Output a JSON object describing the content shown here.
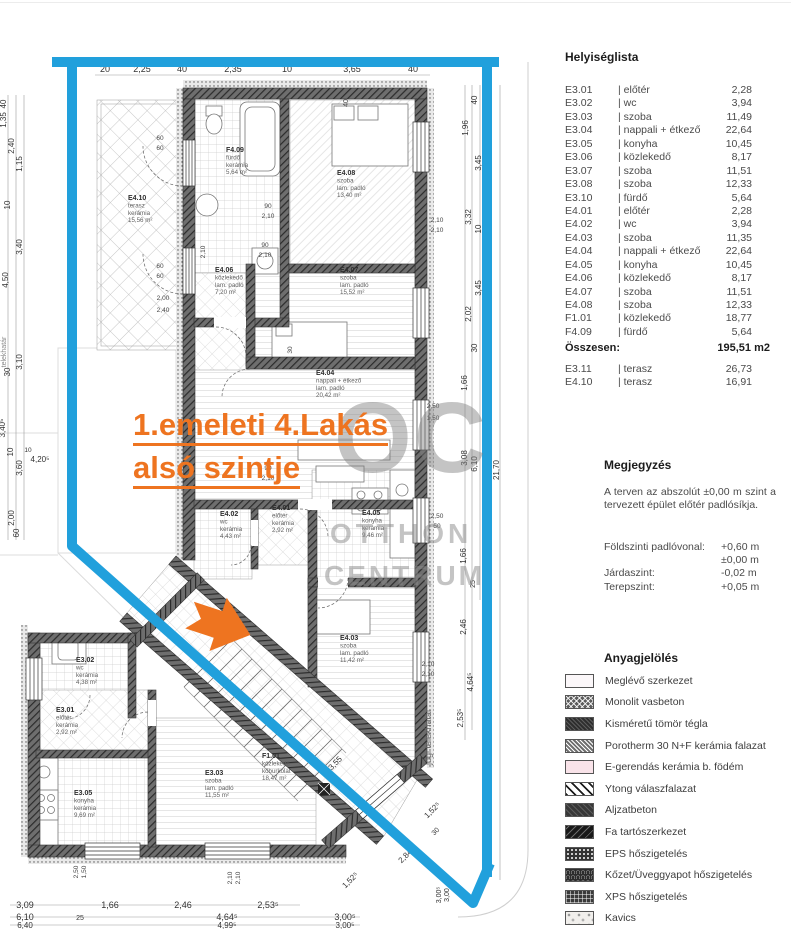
{
  "room_list": {
    "title": "Helyiséglista",
    "rows": [
      {
        "code": "E3.01",
        "name": "| előtér",
        "area": "2,28"
      },
      {
        "code": "E3.02",
        "name": "| wc",
        "area": "3,94"
      },
      {
        "code": "E3.03",
        "name": "| szoba",
        "area": "11,49"
      },
      {
        "code": "E3.04",
        "name": "| nappali + étkező",
        "area": "22,64"
      },
      {
        "code": "E3.05",
        "name": "| konyha",
        "area": "10,45"
      },
      {
        "code": "E3.06",
        "name": "| közlekedő",
        "area": "8,17"
      },
      {
        "code": "E3.07",
        "name": "| szoba",
        "area": "11,51"
      },
      {
        "code": "E3.08",
        "name": "| szoba",
        "area": "12,33"
      },
      {
        "code": "E3.10",
        "name": "| fürdő",
        "area": "5,64"
      },
      {
        "code": "E4.01",
        "name": "| előtér",
        "area": "2,28"
      },
      {
        "code": "E4.02",
        "name": "| wc",
        "area": "3,94"
      },
      {
        "code": "E4.03",
        "name": "| szoba",
        "area": "11,35"
      },
      {
        "code": "E4.04",
        "name": "| nappali + étkező",
        "area": "22,64"
      },
      {
        "code": "E4.05",
        "name": "| konyha",
        "area": "10,45"
      },
      {
        "code": "E4.06",
        "name": "| közlekedő",
        "area": "8,17"
      },
      {
        "code": "E4.07",
        "name": "| szoba",
        "area": "11,51"
      },
      {
        "code": "E4.08",
        "name": "| szoba",
        "area": "12,33"
      },
      {
        "code": "F1.01",
        "name": "| közlekedő",
        "area": "18,77"
      },
      {
        "code": "F4.09",
        "name": "| fürdő",
        "area": "5,64"
      }
    ]
  },
  "total": {
    "label": "Összesen:",
    "value": "195,51 m2"
  },
  "terrace_rows": [
    {
      "code": "E3.11",
      "name": "| terasz",
      "area": "26,73"
    },
    {
      "code": "E4.10",
      "name": "| terasz",
      "area": "16,91"
    }
  ],
  "notes": {
    "title": "Megjegyzés",
    "body": "A terven az abszolút ±0,00 m szint a tervezett épület előtér padlósíkja.",
    "levels": [
      {
        "label": "Földszinti padlóvonal:",
        "value": "+0,60 m"
      },
      {
        "label": "",
        "value": "±0,00 m"
      },
      {
        "label": "Járdaszint:",
        "value": "-0,02 m"
      },
      {
        "label": "Terepszint:",
        "value": "+0,05 m"
      }
    ]
  },
  "materials": {
    "title": "Anyagjelölés",
    "items": [
      {
        "label": "Meglévő szerkezet",
        "pattern": "existing"
      },
      {
        "label": "Monolit vasbeton",
        "pattern": "rc"
      },
      {
        "label": "Kisméretű tömör tégla",
        "pattern": "brick"
      },
      {
        "label": "Porotherm 30 N+F kerámia falazat",
        "pattern": "porotherm"
      },
      {
        "label": "E-gerendás kerámia b. födém",
        "pattern": "slab"
      },
      {
        "label": "Ytong válaszfalazat",
        "pattern": "ytong"
      },
      {
        "label": "Aljzatbeton",
        "pattern": "screed"
      },
      {
        "label": "Fa tartószerkezet",
        "pattern": "wood"
      },
      {
        "label": "EPS hőszigetelés",
        "pattern": "eps"
      },
      {
        "label": "Kőzet/Üveggyapot hőszigetelés",
        "pattern": "wool"
      },
      {
        "label": "XPS hőszigetelés",
        "pattern": "xps"
      },
      {
        "label": "Kavics",
        "pattern": "gravel"
      }
    ]
  },
  "icons": {
    "logo": "pen-circle-logo"
  },
  "plan": {
    "overlay_title": {
      "line1": "1.emeleti 4.Lakás",
      "line2": "alsó  szintje",
      "color": "#ee7420"
    },
    "watermark": {
      "big": "OC",
      "word1": "OTTHON",
      "word2": "CENTRUM"
    },
    "accent_blue": "#21a0dc",
    "rooms": [
      {
        "x": 226,
        "y": 152,
        "lines": [
          "F4.09",
          "fürdő",
          "kerámia",
          "5,64 m²"
        ]
      },
      {
        "x": 337,
        "y": 175,
        "lines": [
          "E4.08",
          "szoba",
          "lam. padló",
          "13,40 m²"
        ]
      },
      {
        "x": 128,
        "y": 200,
        "lines": [
          "E4.10",
          "terasz",
          "kerámia",
          "15,56 m²"
        ]
      },
      {
        "x": 215,
        "y": 272,
        "lines": [
          "E4.06",
          "közlekedő",
          "lam. padló",
          "7,20 m²"
        ]
      },
      {
        "x": 340,
        "y": 272,
        "lines": [
          "E4.07",
          "szoba",
          "lam. padló",
          "15,52 m²"
        ]
      },
      {
        "x": 316,
        "y": 375,
        "lines": [
          "E4.04",
          "nappali + étkező",
          "lam. padló",
          "20,42 m²"
        ]
      },
      {
        "x": 220,
        "y": 516,
        "lines": [
          "E4.02",
          "wc",
          "kerámia",
          "4,43 m²"
        ]
      },
      {
        "x": 272,
        "y": 510,
        "lines": [
          "E4.01",
          "előtér",
          "kerámia",
          "2,92 m²"
        ]
      },
      {
        "x": 362,
        "y": 515,
        "lines": [
          "E4.05",
          "konyha",
          "kerámia",
          "9,46 m²"
        ]
      },
      {
        "x": 340,
        "y": 640,
        "lines": [
          "E4.03",
          "szoba",
          "lam. padló",
          "11,42 m²"
        ]
      },
      {
        "x": 76,
        "y": 662,
        "lines": [
          "E3.02",
          "wc",
          "kerámia",
          "4,38 m²"
        ]
      },
      {
        "x": 56,
        "y": 712,
        "lines": [
          "E3.01",
          "előtér",
          "kerámia",
          "2,92 m²"
        ]
      },
      {
        "x": 74,
        "y": 795,
        "lines": [
          "E3.05",
          "konyha",
          "kerámia",
          "9,69 m²"
        ]
      },
      {
        "x": 205,
        "y": 775,
        "lines": [
          "E3.03",
          "szoba",
          "lam. padló",
          "11,55 m²"
        ]
      },
      {
        "x": 262,
        "y": 758,
        "lines": [
          "F1.01",
          "közlekedő",
          "kőburkolat",
          "18,47 m²"
        ]
      }
    ],
    "dims": [
      {
        "t": "20",
        "x": 105,
        "y": 72,
        "s": 9
      },
      {
        "t": "2,25",
        "x": 142,
        "y": 72,
        "s": 9
      },
      {
        "t": "40",
        "x": 182,
        "y": 72,
        "s": 9
      },
      {
        "t": "2,35",
        "x": 233,
        "y": 72,
        "s": 9
      },
      {
        "t": "10",
        "x": 287,
        "y": 72,
        "s": 9
      },
      {
        "t": "3,65",
        "x": 352,
        "y": 72,
        "s": 9
      },
      {
        "t": "40",
        "x": 413,
        "y": 72,
        "s": 9
      },
      {
        "t": "40",
        "x": 6,
        "y": 104,
        "r": -90
      },
      {
        "t": "1,35",
        "x": 6,
        "y": 120,
        "r": -90
      },
      {
        "t": "2,40",
        "x": 14,
        "y": 146,
        "r": -90
      },
      {
        "t": "1,15",
        "x": 22,
        "y": 164,
        "r": -90
      },
      {
        "t": "10",
        "x": 10,
        "y": 205,
        "r": -90
      },
      {
        "t": "3,40",
        "x": 22,
        "y": 247,
        "r": -90
      },
      {
        "t": "4,50",
        "x": 8,
        "y": 280,
        "r": -90
      },
      {
        "t": "3,10",
        "x": 22,
        "y": 362,
        "r": -90
      },
      {
        "t": "30",
        "x": 10,
        "y": 372,
        "r": -90
      },
      {
        "t": "3,40⁵",
        "x": 5,
        "y": 428,
        "r": -90
      },
      {
        "t": "3,60",
        "x": 22,
        "y": 468,
        "r": -90
      },
      {
        "t": "10",
        "x": 13,
        "y": 452,
        "r": -90
      },
      {
        "t": "2,00",
        "x": 14,
        "y": 518,
        "r": -90
      },
      {
        "t": "60",
        "x": 19,
        "y": 533,
        "r": -90
      },
      {
        "t": "telekhatár",
        "x": 6,
        "y": 352,
        "r": -90,
        "s": 7,
        "c": "#888"
      },
      {
        "t": "4,20⁵",
        "x": 40,
        "y": 462
      },
      {
        "t": "10",
        "x": 28,
        "y": 452,
        "s": 6.5
      },
      {
        "t": "40",
        "x": 477,
        "y": 100,
        "r": -90
      },
      {
        "t": "1,96",
        "x": 468,
        "y": 128,
        "r": -90
      },
      {
        "t": "3,45",
        "x": 481,
        "y": 163,
        "r": -90
      },
      {
        "t": "3,32",
        "x": 471,
        "y": 217,
        "r": -90
      },
      {
        "t": "10",
        "x": 481,
        "y": 229,
        "r": -90
      },
      {
        "t": "3,45",
        "x": 481,
        "y": 288,
        "r": -90
      },
      {
        "t": "2,02",
        "x": 471,
        "y": 314,
        "r": -90
      },
      {
        "t": "30",
        "x": 477,
        "y": 348,
        "r": -90
      },
      {
        "t": "1,66",
        "x": 467,
        "y": 383,
        "r": -90
      },
      {
        "t": "3,08",
        "x": 467,
        "y": 458,
        "r": -90
      },
      {
        "t": "6,10",
        "x": 477,
        "y": 464,
        "r": -90
      },
      {
        "t": "21,70",
        "x": 499,
        "y": 470,
        "r": -90
      },
      {
        "t": "1,66",
        "x": 466,
        "y": 556,
        "r": -90
      },
      {
        "t": "25",
        "x": 475,
        "y": 584,
        "r": -90,
        "s": 7
      },
      {
        "t": "2,46",
        "x": 466,
        "y": 627,
        "r": -90
      },
      {
        "t": "4,64⁵",
        "x": 473,
        "y": 682,
        "r": -90
      },
      {
        "t": "2,53⁵",
        "x": 463,
        "y": 718,
        "r": -90
      },
      {
        "t": "jogi telekhatár",
        "x": 431,
        "y": 737,
        "r": -90,
        "s": 9,
        "c": "#666"
      },
      {
        "t": "2,10",
        "x": 428,
        "y": 666,
        "s": 6.5,
        "c": "#444"
      },
      {
        "t": "2,10",
        "x": 428,
        "y": 676,
        "s": 6.5,
        "c": "#444"
      },
      {
        "t": "2,10",
        "x": 437,
        "y": 222,
        "s": 6.5,
        "c": "#444"
      },
      {
        "t": "2,10",
        "x": 437,
        "y": 232,
        "s": 6.5,
        "c": "#444"
      },
      {
        "t": "90",
        "x": 268,
        "y": 208,
        "s": 6.5,
        "c": "#444"
      },
      {
        "t": "2,10",
        "x": 268,
        "y": 218,
        "s": 6.5,
        "c": "#444"
      },
      {
        "t": "90",
        "x": 265,
        "y": 247,
        "s": 6.5,
        "c": "#444"
      },
      {
        "t": "2,10",
        "x": 265,
        "y": 257,
        "s": 6.5,
        "c": "#444"
      },
      {
        "t": "90",
        "x": 268,
        "y": 470,
        "s": 6.5,
        "c": "#444"
      },
      {
        "t": "2,10",
        "x": 268,
        "y": 480,
        "s": 6.5,
        "c": "#444"
      },
      {
        "t": "2,00",
        "x": 163,
        "y": 300,
        "s": 6.5,
        "c": "#444"
      },
      {
        "t": "2,40",
        "x": 163,
        "y": 312,
        "s": 6.5,
        "c": "#444"
      },
      {
        "t": "60",
        "x": 160,
        "y": 140,
        "s": 6.5,
        "c": "#444"
      },
      {
        "t": "60",
        "x": 160,
        "y": 150,
        "s": 6.5,
        "c": "#444"
      },
      {
        "t": "60",
        "x": 160,
        "y": 268,
        "s": 6.5,
        "c": "#444"
      },
      {
        "t": "60",
        "x": 160,
        "y": 278,
        "s": 6.5,
        "c": "#444"
      },
      {
        "t": "2,50",
        "x": 433,
        "y": 408,
        "s": 6.5,
        "c": "#444"
      },
      {
        "t": "1,50",
        "x": 433,
        "y": 420,
        "s": 6.5,
        "c": "#444"
      },
      {
        "t": "2,50",
        "x": 437,
        "y": 518,
        "s": 6.5,
        "c": "#444"
      },
      {
        "t": "50",
        "x": 437,
        "y": 528,
        "s": 6.5,
        "c": "#444"
      },
      {
        "t": "2,10",
        "x": 205,
        "y": 252,
        "r": -90,
        "s": 6.5,
        "c": "#444"
      },
      {
        "t": "30",
        "x": 292,
        "y": 350,
        "r": -90,
        "s": 6.5,
        "c": "#444"
      },
      {
        "t": "40",
        "x": 348,
        "y": 103,
        "r": -90,
        "s": 7,
        "c": "#444"
      },
      {
        "t": "3,00⁵",
        "x": 441,
        "y": 895,
        "r": -90,
        "s": 7
      },
      {
        "t": "3,00",
        "x": 449,
        "y": 895,
        "r": -90,
        "s": 7
      },
      {
        "t": "2,10",
        "x": 232,
        "y": 878,
        "r": -90,
        "s": 6.5,
        "c": "#444"
      },
      {
        "t": "2,10",
        "x": 240,
        "y": 878,
        "r": -90,
        "s": 6.5,
        "c": "#444"
      },
      {
        "t": "2,50",
        "x": 78,
        "y": 872,
        "r": -90,
        "s": 6.5,
        "c": "#444"
      },
      {
        "t": "1,50",
        "x": 86,
        "y": 872,
        "r": -90,
        "s": 6.5,
        "c": "#444"
      },
      {
        "t": "3,09",
        "x": 25,
        "y": 908,
        "s": 9
      },
      {
        "t": "1,66",
        "x": 110,
        "y": 908,
        "s": 9
      },
      {
        "t": "2,46",
        "x": 183,
        "y": 908,
        "s": 9
      },
      {
        "t": "2,53⁵",
        "x": 268,
        "y": 908,
        "s": 9
      },
      {
        "t": "6,10",
        "x": 25,
        "y": 920,
        "s": 9
      },
      {
        "t": "25",
        "x": 80,
        "y": 920,
        "s": 7
      },
      {
        "t": "4,64⁵",
        "x": 227,
        "y": 920,
        "s": 9
      },
      {
        "t": "3,00⁵",
        "x": 345,
        "y": 920,
        "s": 9
      },
      {
        "t": "6,40",
        "x": 25,
        "y": 928
      },
      {
        "t": "4,99⁵",
        "x": 227,
        "y": 928
      },
      {
        "t": "3,00⁵",
        "x": 345,
        "y": 928
      },
      {
        "t": "3,55",
        "x": 337,
        "y": 765,
        "r": -45
      },
      {
        "t": "1,52⁵",
        "x": 352,
        "y": 882,
        "r": -45
      },
      {
        "t": "2,84",
        "x": 407,
        "y": 858,
        "r": -45
      },
      {
        "t": "30",
        "x": 437,
        "y": 833,
        "r": -45,
        "s": 7
      },
      {
        "t": "1,52⁵",
        "x": 434,
        "y": 812,
        "r": -45
      }
    ]
  }
}
